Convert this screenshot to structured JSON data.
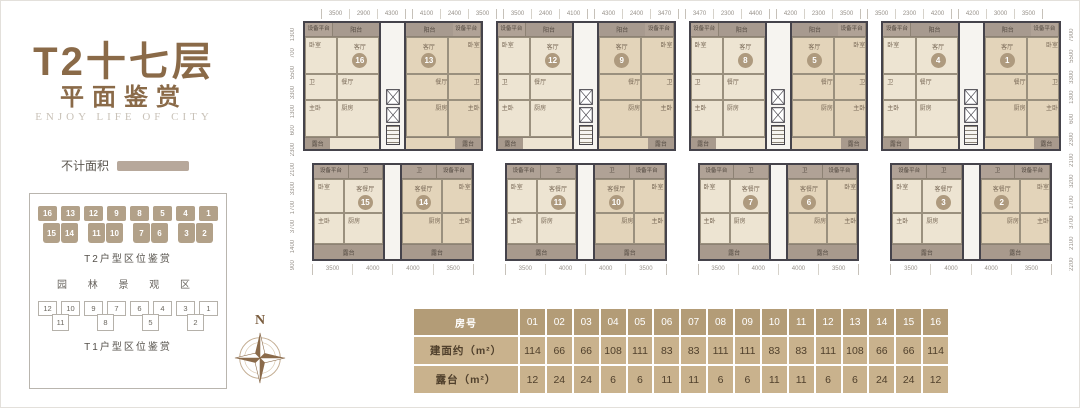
{
  "left_panel": {
    "title": "T2十七层",
    "subtitle": "平面鉴赏",
    "english": "ENJOY LIFE OF CITY",
    "legend_label": "不计面积",
    "garden_label": "园 林 景 观 区",
    "compass_label": "N",
    "t2_locator": {
      "caption": "T2户型区位鉴赏",
      "top_row": [
        "16",
        "13",
        "12",
        "9",
        "8",
        "5",
        "4",
        "1"
      ],
      "bottom_pairs": [
        [
          "15",
          "14"
        ],
        [
          "11",
          "10"
        ],
        [
          "7",
          "6"
        ],
        [
          "3",
          "2"
        ]
      ]
    },
    "t1_locator": {
      "caption": "T1户型区位鉴赏",
      "top_row": [
        "12",
        "10",
        "9",
        "7",
        "6",
        "4",
        "3",
        "1"
      ],
      "bottom_row": [
        "11",
        "8",
        "5",
        "2"
      ]
    }
  },
  "plan": {
    "top_dim_groups": [
      [
        "3500",
        "2900",
        "4300"
      ],
      [
        "4100",
        "2400",
        "3500"
      ],
      [
        "3500",
        "2400",
        "4100"
      ],
      [
        "4300",
        "2400",
        "3470"
      ],
      [
        "3470",
        "2300",
        "4400"
      ],
      [
        "4200",
        "2300",
        "3500"
      ],
      [
        "3500",
        "2300",
        "4200"
      ],
      [
        "4200",
        "3000",
        "3500"
      ]
    ],
    "bottom_dims": [
      "3500",
      "4000",
      "4000",
      "3500"
    ],
    "left_dims": [
      "1300",
      "700",
      "5500",
      "3300",
      "1300",
      "600",
      "2300",
      "2100",
      "3300",
      "1700",
      "3700",
      "1400",
      "900"
    ],
    "right_dims": [
      "7900",
      "5500",
      "3300",
      "1300",
      "600",
      "2300",
      "2100",
      "3200",
      "1700",
      "3700",
      "2100",
      "2200"
    ],
    "top_blocks": [
      [
        "16",
        "13"
      ],
      [
        "12",
        "9"
      ],
      [
        "8",
        "5"
      ],
      [
        "4",
        "1"
      ]
    ],
    "bottom_blocks": [
      [
        "15",
        "14"
      ],
      [
        "11",
        "10"
      ],
      [
        "7",
        "6"
      ],
      [
        "3",
        "2"
      ]
    ],
    "labels": {
      "balcony": "阳台",
      "equipment": "设备平台",
      "bedroom": "卧室",
      "living": "客厅",
      "living_dining": "客餐厅",
      "dining": "餐厅",
      "kitchen": "厨房",
      "master": "主卧",
      "bath": "卫",
      "terrace": "露台"
    }
  },
  "table": {
    "row_labels": [
      "房号",
      "建面约（m²）",
      "露台（m²）"
    ],
    "room_numbers": [
      "01",
      "02",
      "03",
      "04",
      "05",
      "06",
      "07",
      "08",
      "09",
      "10",
      "11",
      "12",
      "13",
      "14",
      "15",
      "16"
    ],
    "area": [
      "114",
      "66",
      "66",
      "108",
      "111",
      "83",
      "83",
      "111",
      "111",
      "83",
      "83",
      "111",
      "108",
      "66",
      "66",
      "114"
    ],
    "terrace": [
      "12",
      "24",
      "24",
      "6",
      "6",
      "11",
      "11",
      "6",
      "6",
      "11",
      "11",
      "6",
      "6",
      "24",
      "24",
      "12"
    ]
  },
  "colors": {
    "title_brown": "#8a6a48",
    "chip_tan": "#b2a189",
    "wall": "#45434b",
    "room_beige": "#ede4d2",
    "room_tan": "#e3d4ba",
    "balcony_gray": "#a79a8f",
    "terrace_gray": "#a89a8d",
    "table_header": "#b39c77",
    "table_cell": "#c9b28d",
    "table_text": "#50402c"
  }
}
